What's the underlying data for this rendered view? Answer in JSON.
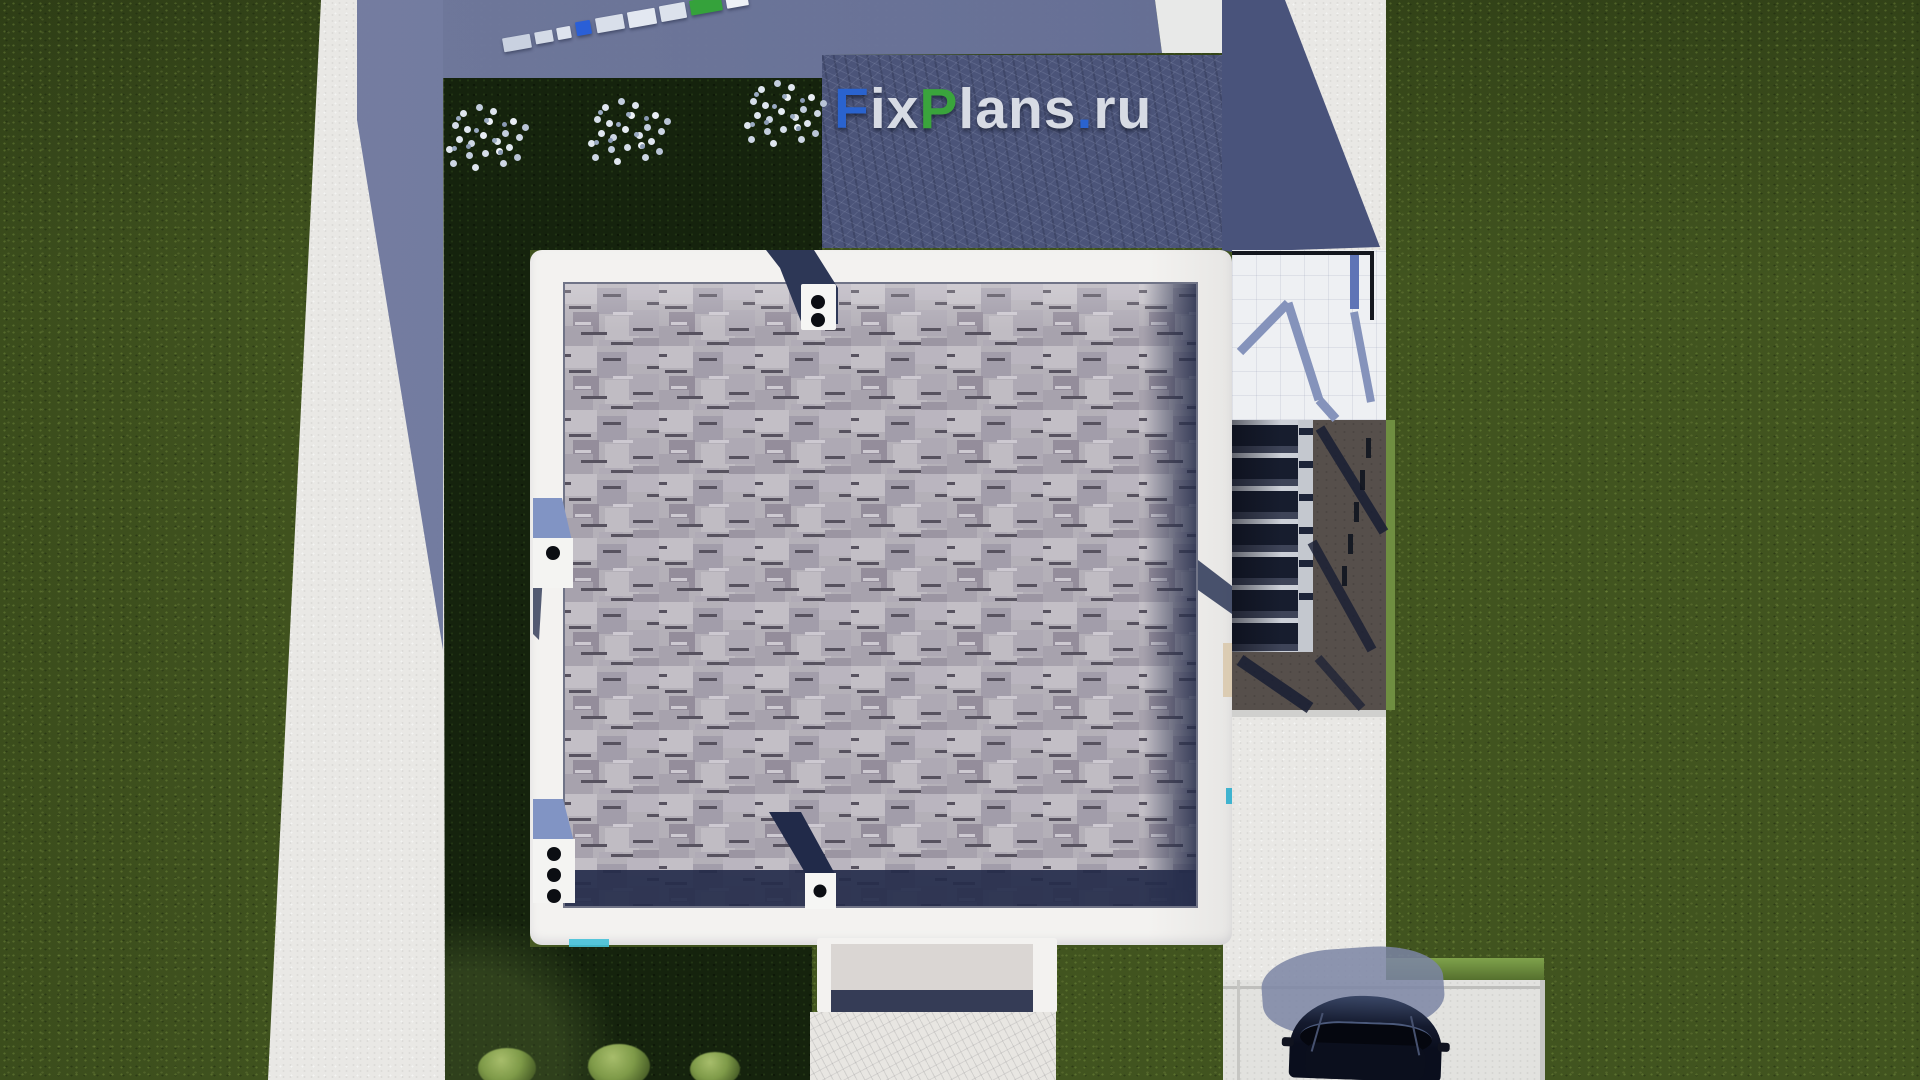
{
  "watermark": {
    "text": "FixPlans.ru",
    "panel_color": "#4b5479",
    "segments": [
      {
        "text": "F",
        "color": "#2a63cf"
      },
      {
        "text": "ix",
        "color": "#d7dbe4"
      },
      {
        "text": "P",
        "color": "#3aa43c"
      },
      {
        "text": "lans",
        "color": "#d7dbe4"
      },
      {
        "text": ".",
        "color": "#2a63cf"
      },
      {
        "text": "ru",
        "color": "#d7dbe4"
      }
    ]
  },
  "scene": {
    "type": "aerial top-down 3D architectural render",
    "house": {
      "roof": "gray asphalt shingles",
      "parapet": "white flat border",
      "roof_vents": 4,
      "vent_dot_counts": {
        "top": 2,
        "left_middle": 1,
        "bottom_left": 3,
        "bottom_center": 1
      }
    },
    "landscape": {
      "lawn_color": "#41541f",
      "shadow_lawn_color": "#15230d",
      "white_blossom_bushes": 3,
      "green_bushes": 3,
      "concrete_path_left": true,
      "driveway_bottom_right": true,
      "walkway_to_entrance": true
    },
    "structures": {
      "terrace_right": "white with railing shadows",
      "stairs_right": "dark treads with light stringer",
      "landing_pad": "#564f4b",
      "entrance_porch": "white frame with gray pad",
      "fence_panel_colors": [
        "#c9d1e0",
        "#2a5fd7",
        "#35a23b"
      ]
    },
    "car": {
      "color": "dark navy black",
      "position": "bottom-right driveway"
    },
    "shadows": {
      "large_cast_shadow_color": "#69729a",
      "top_right_shadow_color": "#49537b"
    }
  }
}
